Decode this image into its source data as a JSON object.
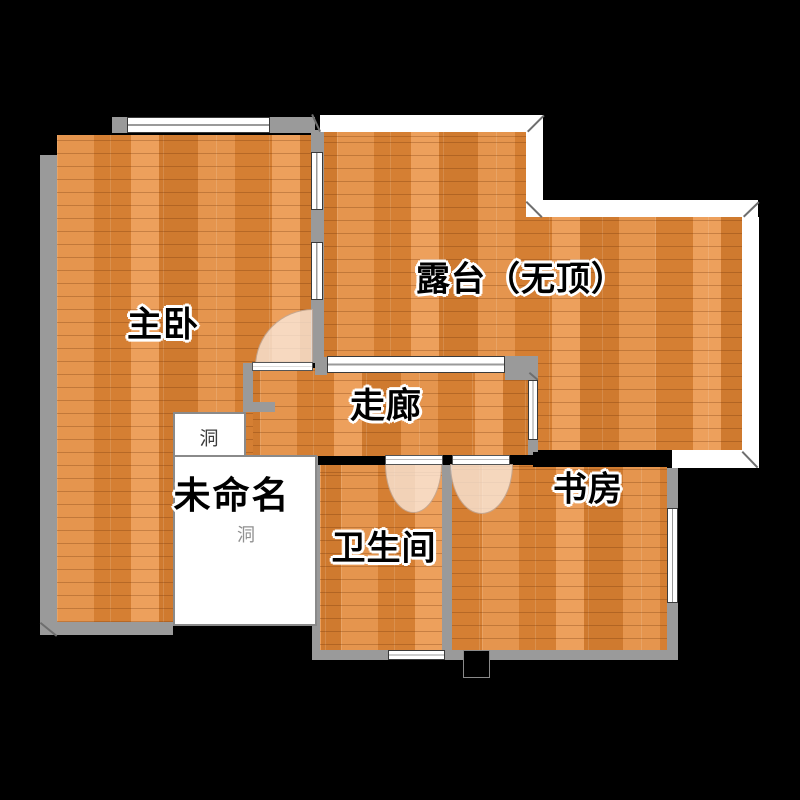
{
  "floorplan": {
    "title": "apartment-floor-plan",
    "rooms": {
      "master_bedroom": {
        "label": "主卧"
      },
      "terrace": {
        "label": "露台（无顶）"
      },
      "corridor": {
        "label": "走廊"
      },
      "unnamed": {
        "label": "未命名",
        "hole_upper": "洞",
        "hole_lower": "洞"
      },
      "bathroom": {
        "label": "卫生间"
      },
      "study": {
        "label": "书房"
      }
    },
    "colors": {
      "background": "#000000",
      "floor_wood_base": "#e0883a",
      "floor_wood_dark": "#cf7a2f",
      "floor_wood_light": "#eda05c",
      "wall_gray": "#9a9a9a",
      "wall_black": "#000000",
      "terrace_railing": "#ffffff",
      "window_fill": "#ffffff",
      "door_arc_fill": "#fae9dc",
      "unnamed_room_fill": "#ffffff",
      "label_text": "#000000",
      "label_halo": "#ffffff",
      "hole_text_upper": "#3c3c3c",
      "hole_text_lower": "#909090"
    }
  }
}
